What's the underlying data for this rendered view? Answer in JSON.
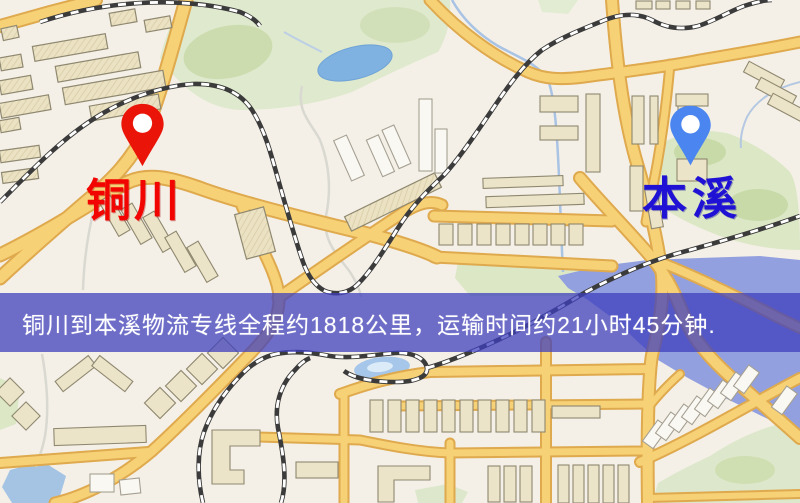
{
  "markers": {
    "origin": {
      "label": "铜川",
      "text_color": "#f20500",
      "pin_color": "#ea1408"
    },
    "destination": {
      "label": "本溪",
      "text_color": "#2012d4",
      "pin_color": "#4b86f0"
    }
  },
  "banner": {
    "text": "铜川到本溪物流专线全程约1818公里，运输时间约21小时45分钟.",
    "background_color": "#3e40bd",
    "text_color": "#ffffff"
  },
  "route": {
    "from": "铜川",
    "to": "本溪",
    "distance_km": "1818",
    "duration_hours": "21",
    "duration_minutes": "45"
  },
  "map_palette": {
    "background": "#f4f0e7",
    "road_fill": "#f7d176",
    "road_casing": "#dfa94e",
    "railway": "#3b3b3b",
    "water": "#7fb1e1",
    "river": "#92a0df",
    "park": "#dfe9cd",
    "building": "#ece4c8"
  }
}
